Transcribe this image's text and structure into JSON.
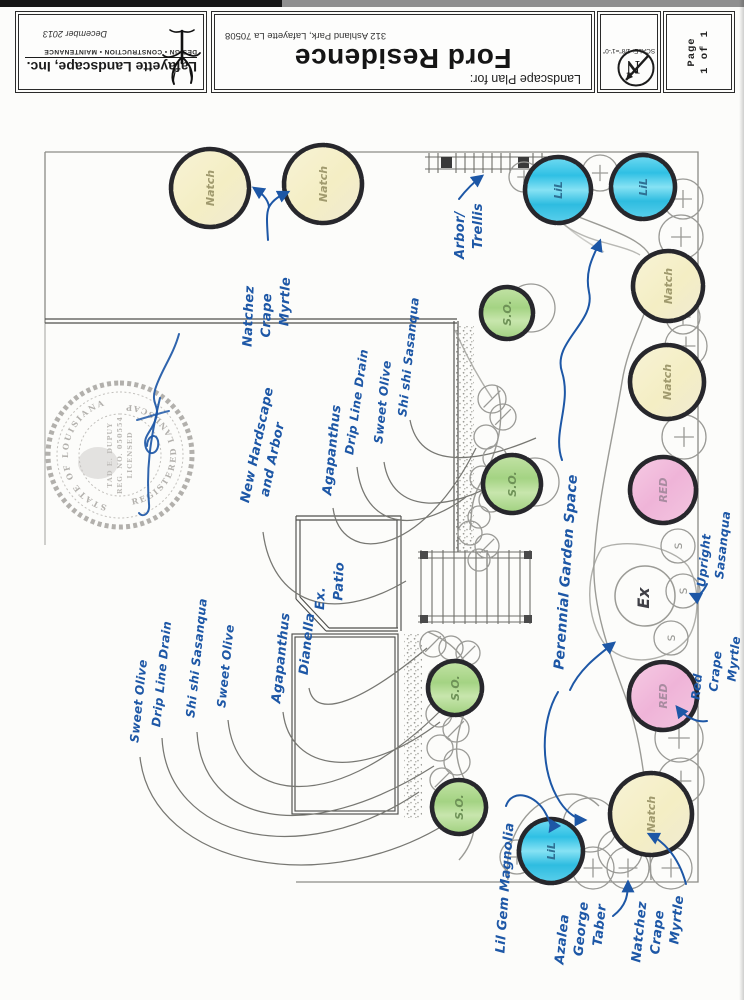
{
  "palette": {
    "ink": "#1d57a6",
    "pencil": "#8a8a86",
    "outline": "#27272c",
    "yellow": "#f6f1cf",
    "blue": "#45c9e8",
    "green": "#aed790",
    "pink": "#f2c0de"
  },
  "title_block": {
    "company": "Lafayette Landscape, Inc.",
    "tagline": "DESIGN • CONSTRUCTION • MAINTENANCE",
    "date": "December 2013",
    "plan_for": "Landscape Plan for:",
    "residence": "Ford Residence",
    "address": "312 Ashland Park, Lafayette La 70508",
    "scale": "SCALE: 1/8\"=1'-0\"",
    "north_letter": "N",
    "page": [
      "Page",
      "1 of 1"
    ]
  },
  "seal": {
    "arc_left": "STATE OF LOUISIANA",
    "arc_right": "REGISTERED LANDSCAPE ARCHITECT",
    "center": [
      "TAD E. DUPUY",
      "REG. NO. 050554",
      "LICENSED"
    ]
  },
  "plan": {
    "ex_label": "Ex",
    "plants": [
      {
        "type": "yellow",
        "label": "Natch",
        "x": 210,
        "y": 188,
        "r": 39
      },
      {
        "type": "yellow",
        "label": "Natch",
        "x": 323,
        "y": 184,
        "r": 39
      },
      {
        "type": "blue",
        "label": "LiL",
        "x": 558,
        "y": 190,
        "r": 33
      },
      {
        "type": "blue",
        "label": "LiL",
        "x": 643,
        "y": 187,
        "r": 32
      },
      {
        "type": "yellow",
        "label": "Natch",
        "x": 668,
        "y": 286,
        "r": 35
      },
      {
        "type": "yellow",
        "label": "Natch",
        "x": 667,
        "y": 382,
        "r": 37
      },
      {
        "type": "green",
        "label": "S.O.",
        "x": 507,
        "y": 313,
        "r": 26
      },
      {
        "type": "green",
        "label": "S.O.",
        "x": 512,
        "y": 484,
        "r": 29
      },
      {
        "type": "pink",
        "label": "RED",
        "x": 663,
        "y": 490,
        "r": 33
      },
      {
        "type": "pink",
        "label": "RED",
        "x": 663,
        "y": 696,
        "r": 34
      },
      {
        "type": "green",
        "label": "S.O.",
        "x": 455,
        "y": 688,
        "r": 27
      },
      {
        "type": "green",
        "label": "S.O.",
        "x": 459,
        "y": 807,
        "r": 27
      },
      {
        "type": "yellow",
        "label": "Natch",
        "x": 651,
        "y": 814,
        "r": 41
      },
      {
        "type": "blue",
        "label": "LiL",
        "x": 551,
        "y": 851,
        "r": 32
      }
    ],
    "small_circles": [
      {
        "g": "+",
        "x": 600,
        "y": 173,
        "r": 18
      },
      {
        "g": "+",
        "x": 524,
        "y": 177,
        "r": 15
      },
      {
        "g": "+",
        "x": 683,
        "y": 199,
        "r": 20
      },
      {
        "g": "+",
        "x": 681,
        "y": 237,
        "r": 22
      },
      {
        "g": "+",
        "x": 683,
        "y": 317,
        "r": 17
      },
      {
        "g": "+",
        "x": 686,
        "y": 346,
        "r": 21
      },
      {
        "g": "+",
        "x": 684,
        "y": 437,
        "r": 22
      },
      {
        "g": "+",
        "x": 679,
        "y": 738,
        "r": 24
      },
      {
        "g": "+",
        "x": 681,
        "y": 781,
        "r": 23
      },
      {
        "g": "+",
        "x": 593,
        "y": 868,
        "r": 21
      },
      {
        "g": "+",
        "x": 628,
        "y": 868,
        "r": 21
      },
      {
        "g": "+",
        "x": 671,
        "y": 868,
        "r": 21
      },
      {
        "g": "+",
        "x": 517,
        "y": 857,
        "r": 17
      },
      {
        "g": "s",
        "x": 678,
        "y": 546,
        "r": 17
      },
      {
        "g": "s",
        "x": 683,
        "y": 591,
        "r": 17
      },
      {
        "g": "s",
        "x": 671,
        "y": 638,
        "r": 17
      },
      {
        "g": "/",
        "x": 492,
        "y": 399,
        "r": 14
      },
      {
        "g": "/",
        "x": 503,
        "y": 417,
        "r": 13
      },
      {
        "g": "/",
        "x": 433,
        "y": 644,
        "r": 13
      },
      {
        "g": "/",
        "x": 468,
        "y": 653,
        "r": 12
      },
      {
        "g": "/",
        "x": 457,
        "y": 692,
        "r": 13
      },
      {
        "g": "/",
        "x": 456,
        "y": 729,
        "r": 13
      },
      {
        "g": "/",
        "x": 442,
        "y": 780,
        "r": 12
      },
      {
        "g": "/",
        "x": 487,
        "y": 546,
        "r": 12
      },
      {
        "g": "",
        "x": 470,
        "y": 533,
        "r": 12
      },
      {
        "g": "",
        "x": 486,
        "y": 437,
        "r": 12
      },
      {
        "g": "",
        "x": 495,
        "y": 458,
        "r": 12
      },
      {
        "g": "",
        "x": 482,
        "y": 478,
        "r": 12
      },
      {
        "g": "",
        "x": 491,
        "y": 500,
        "r": 12
      },
      {
        "g": "",
        "x": 479,
        "y": 517,
        "r": 11
      },
      {
        "g": "",
        "x": 451,
        "y": 648,
        "r": 12
      },
      {
        "g": "",
        "x": 441,
        "y": 679,
        "r": 13
      },
      {
        "g": "",
        "x": 439,
        "y": 714,
        "r": 13
      },
      {
        "g": "",
        "x": 440,
        "y": 748,
        "r": 13
      },
      {
        "g": "",
        "x": 457,
        "y": 762,
        "r": 13
      },
      {
        "g": "",
        "x": 459,
        "y": 793,
        "r": 12
      },
      {
        "g": "",
        "x": 531,
        "y": 308,
        "r": 24
      },
      {
        "g": "",
        "x": 535,
        "y": 482,
        "r": 24
      },
      {
        "g": "",
        "x": 590,
        "y": 825,
        "r": 27
      },
      {
        "g": "",
        "x": 620,
        "y": 851,
        "r": 22
      },
      {
        "g": "",
        "x": 479,
        "y": 560,
        "r": 11
      }
    ],
    "labels": [
      {
        "name": "label-natchez-top",
        "lines": [
          "Natchez",
          "Crape",
          "Myrtle"
        ],
        "x": 268,
        "y": 312,
        "rot": -88,
        "size": 13
      },
      {
        "name": "label-arbor-trellis",
        "lines": [
          "Arbor/",
          "Trellis"
        ],
        "x": 470,
        "y": 231,
        "rot": -90,
        "size": 13
      },
      {
        "name": "label-new-hardscape",
        "lines": [
          "New Hardscape",
          "and Arbor"
        ],
        "x": 267,
        "y": 447,
        "rot": -78,
        "size": 13
      },
      {
        "name": "label-agapanthus-top",
        "lines": [
          "Agapanthus"
        ],
        "x": 333,
        "y": 450,
        "rot": -84,
        "size": 13
      },
      {
        "name": "label-drip-line-top",
        "lines": [
          "Drip Line Drain"
        ],
        "x": 357,
        "y": 402,
        "rot": -82,
        "size": 12
      },
      {
        "name": "label-sweet-olive-top",
        "lines": [
          "Sweet Olive"
        ],
        "x": 383,
        "y": 402,
        "rot": -84,
        "size": 12
      },
      {
        "name": "label-shishi-top",
        "lines": [
          "Shi shi Sasanqua"
        ],
        "x": 409,
        "y": 357,
        "rot": -84,
        "size": 12
      },
      {
        "name": "label-ex-patio",
        "lines": [
          "Ex.",
          "Patio"
        ],
        "x": 331,
        "y": 586,
        "rot": -88,
        "size": 13
      },
      {
        "name": "label-dianella",
        "lines": [
          "Dianella"
        ],
        "x": 308,
        "y": 644,
        "rot": -84,
        "size": 13
      },
      {
        "name": "label-agapanthus-bottom",
        "lines": [
          "Agapanthus"
        ],
        "x": 282,
        "y": 658,
        "rot": -84,
        "size": 13
      },
      {
        "name": "label-sweet-olive-mid",
        "lines": [
          "Sweet Olive"
        ],
        "x": 226,
        "y": 666,
        "rot": -84,
        "size": 12
      },
      {
        "name": "label-shishi-bottom",
        "lines": [
          "Shi shi Sasanqua"
        ],
        "x": 197,
        "y": 658,
        "rot": -84,
        "size": 12
      },
      {
        "name": "label-drip-line-bottom",
        "lines": [
          "Drip Line Drain"
        ],
        "x": 162,
        "y": 674,
        "rot": -84,
        "size": 12
      },
      {
        "name": "label-sweet-olive-bottom",
        "lines": [
          "Sweet Olive"
        ],
        "x": 139,
        "y": 701,
        "rot": -84,
        "size": 12
      },
      {
        "name": "label-perennial-garden",
        "lines": [
          "Perennial Garden Space"
        ],
        "x": 567,
        "y": 572,
        "rot": -86,
        "size": 14
      },
      {
        "name": "label-upright-sasanqua",
        "lines": [
          "Upright",
          "Sasanqua"
        ],
        "x": 714,
        "y": 549,
        "rot": -84,
        "size": 12
      },
      {
        "name": "label-red-crape-myrtle",
        "lines": [
          "Red",
          "Crape",
          "Myrtle"
        ],
        "x": 716,
        "y": 668,
        "rot": -84,
        "size": 12
      },
      {
        "name": "label-lil-gem-magnolia",
        "lines": [
          "Lil Gem Magnolia"
        ],
        "x": 506,
        "y": 888,
        "rot": -86,
        "size": 13
      },
      {
        "name": "label-azalea-george-taber",
        "lines": [
          "Azalea",
          "George",
          "Taber"
        ],
        "x": 582,
        "y": 934,
        "rot": -84,
        "size": 13
      },
      {
        "name": "label-natchez-bottom",
        "lines": [
          "Natchez",
          "Crape",
          "Myrtle"
        ],
        "x": 659,
        "y": 929,
        "rot": -84,
        "size": 13
      }
    ]
  }
}
